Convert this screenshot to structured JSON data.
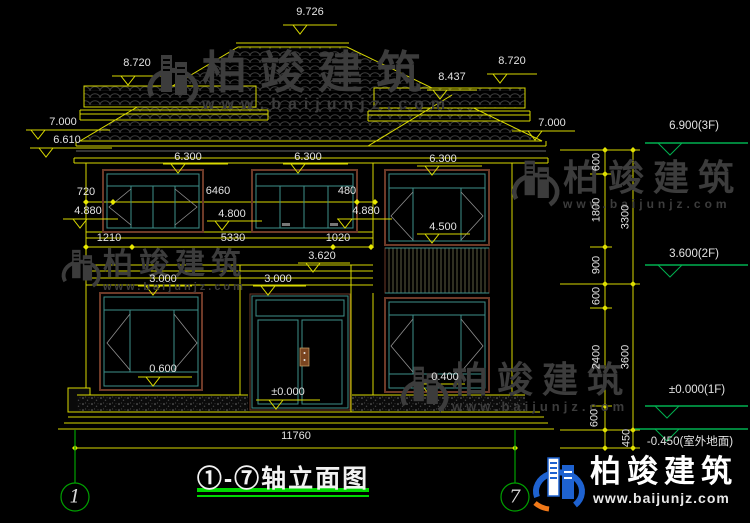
{
  "watermark": {
    "company": "柏竣建筑",
    "website": "www.baijunjz.com"
  },
  "footer": {
    "company": "柏竣建筑",
    "website": "www.baijunjz.com"
  },
  "title_block": {
    "title": "①-⑦轴立面图",
    "axis_left": "1",
    "axis_right": "7"
  },
  "roof": {
    "ridge": "9.726",
    "left_wing": "8.720",
    "right_hip": "8.437",
    "right_wing": "8.720",
    "eave_left_top": "7.000",
    "eave_left_bottom": "6.610",
    "eave_right": "7.000",
    "soffit_left": "6.300",
    "soffit_mid": "6.300",
    "soffit_right": "6.300"
  },
  "floor2": {
    "w720": "720",
    "h4880_left": "4.880",
    "w6460": "6460",
    "h4800": "4.800",
    "w480": "480",
    "h4880_right": "4.880",
    "h4500": "4.500"
  },
  "mid": {
    "w1210": "1210",
    "w5330": "5330",
    "w1020": "1020",
    "h3620": "3.620",
    "h3000_left": "3.000",
    "h3000_right": "3.000"
  },
  "floor1": {
    "h0600": "0.600",
    "h0000": "±0.000",
    "h0400": "0.400"
  },
  "total_width": "11760",
  "right_dims": {
    "inner": [
      "600",
      "1800",
      "900",
      "600",
      "2400",
      "600"
    ],
    "outer": [
      "3300",
      "3600"
    ],
    "ground": "450"
  },
  "levels": {
    "f3": "6.900(3F)",
    "f2": "3.600(2F)",
    "f1": "±0.000(1F)",
    "ground": "-0.450(室外地面)"
  }
}
